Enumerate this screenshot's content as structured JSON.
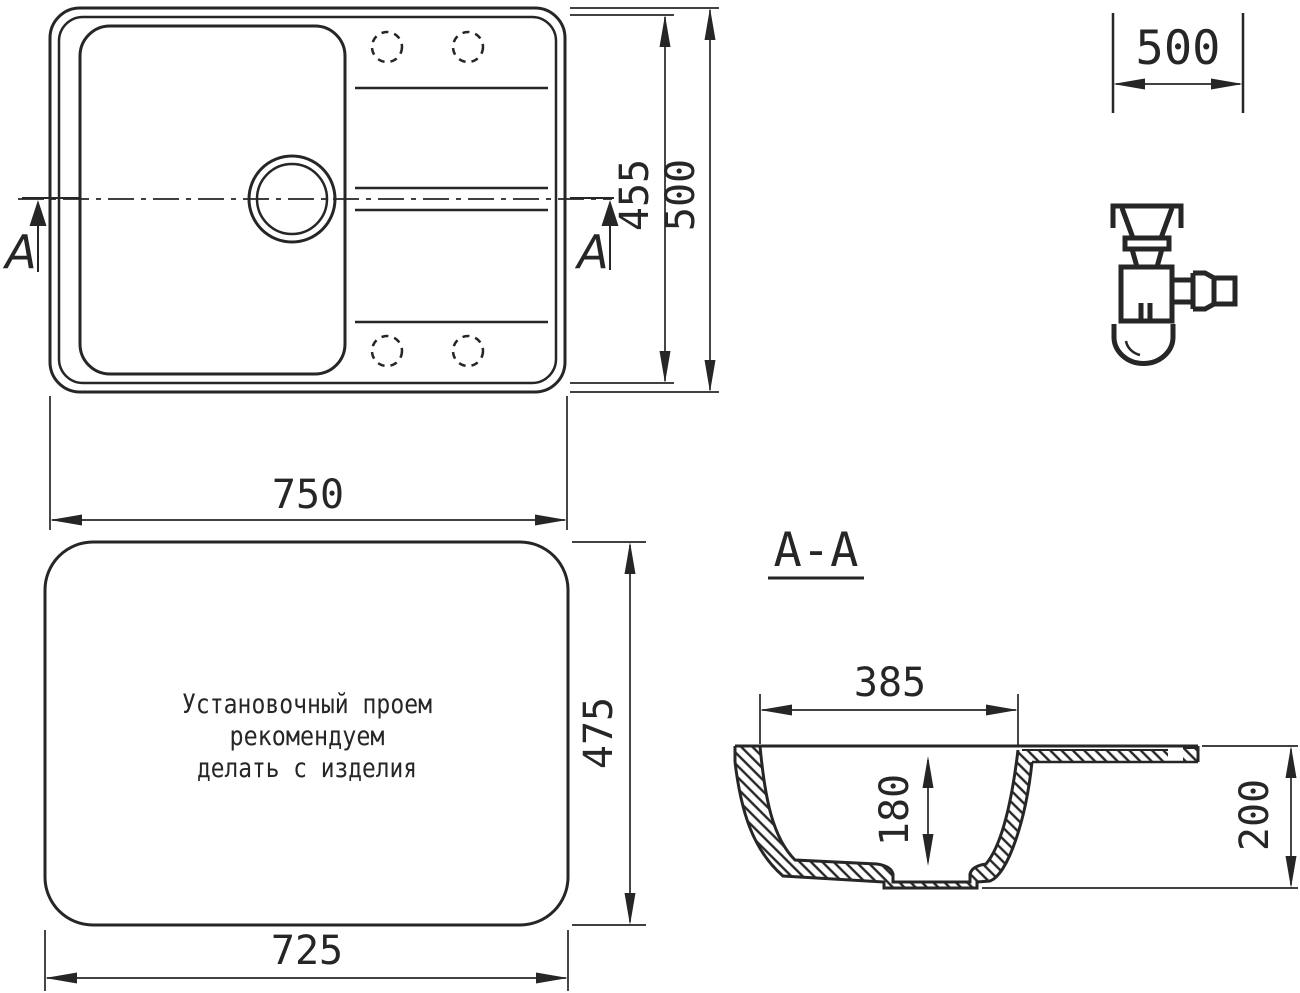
{
  "top_view": {
    "width": "750",
    "outer_height": "500",
    "inner_height": "455",
    "section_letter": "A"
  },
  "cutout_width": "500",
  "installation": {
    "line1": "Установочный проем",
    "line2": "рекомендуем",
    "line3": "делать с изделия",
    "width": "725",
    "height": "475"
  },
  "section": {
    "title": "A-A",
    "bowl_width": "385",
    "bowl_depth": "180",
    "total_depth": "200"
  },
  "icons": {
    "siphon": "siphon-trap-icon",
    "section_arrow": "section-arrow-icon"
  },
  "colors": {
    "line": "#262626",
    "background": "#ffffff"
  }
}
